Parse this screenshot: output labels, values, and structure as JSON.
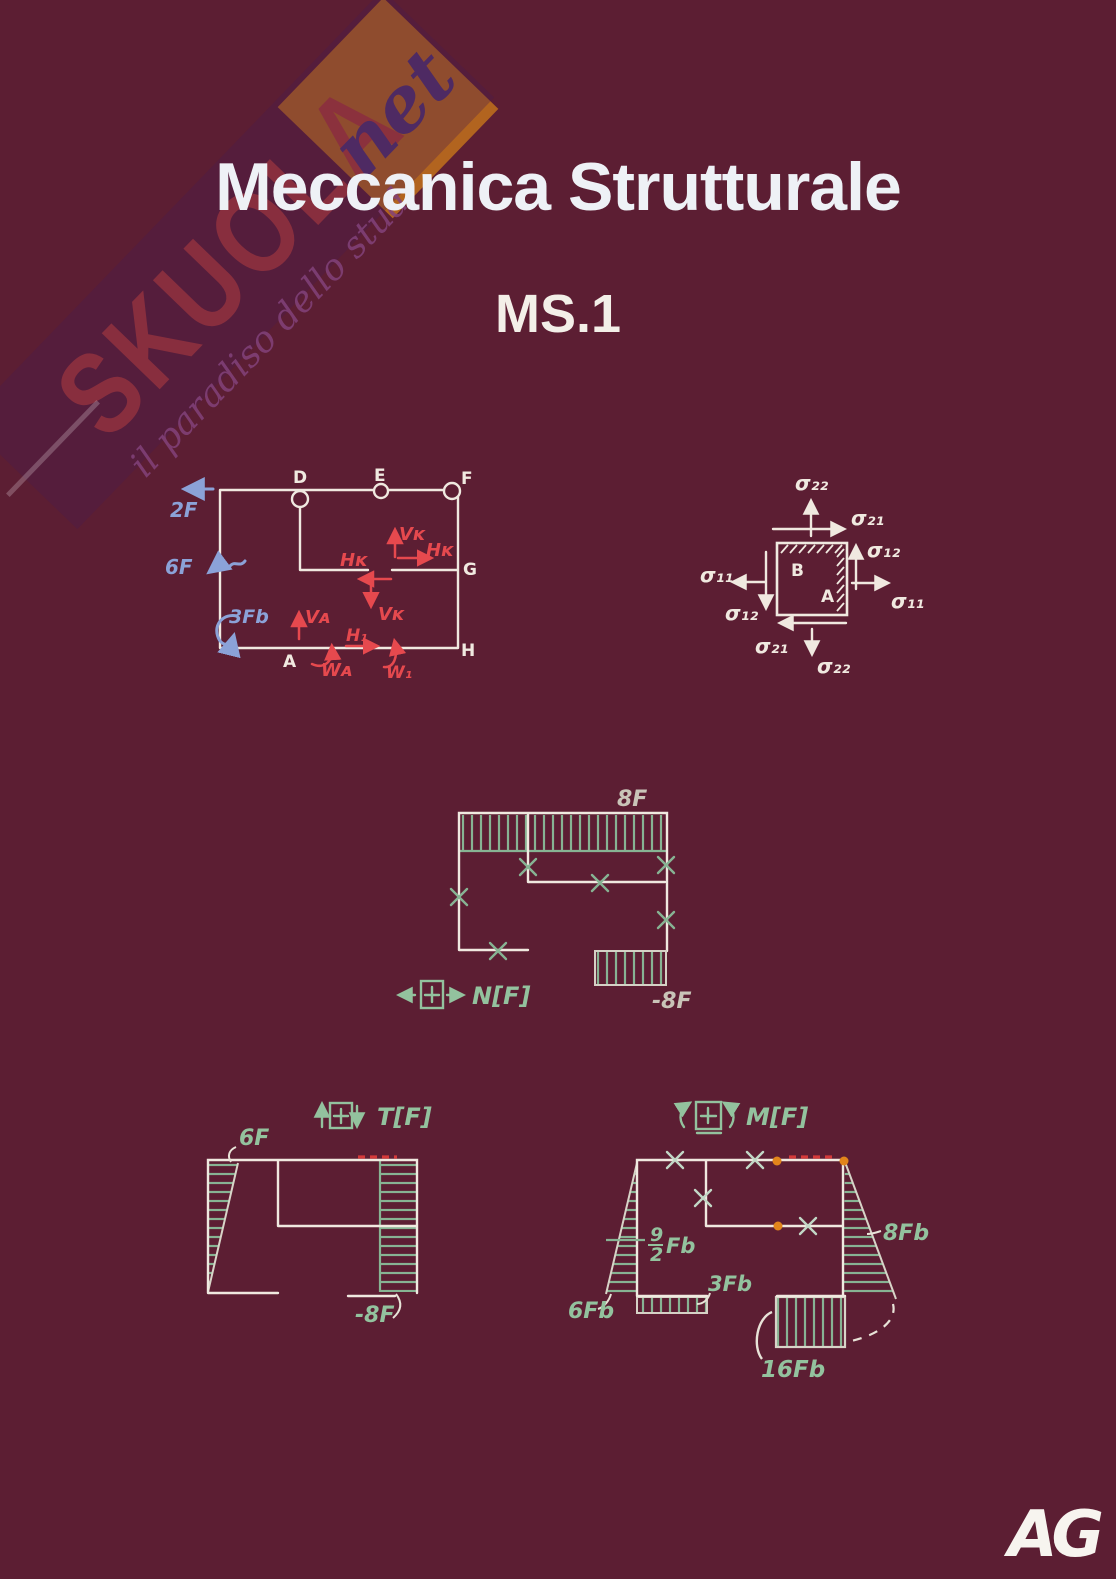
{
  "colors": {
    "background": "#5c1e33",
    "ink_white": "#f0e9e0",
    "annotation_red": "#e6494e",
    "annotation_blue": "#8ba2d8",
    "diagram_green": "#87b393",
    "highlight_orange": "#e2851b",
    "dash_red": "#d43a3a",
    "watermark_band": "#4e1c4e",
    "watermark_brand_red": "#8b2f3e",
    "watermark_orange": "#b2641f",
    "watermark_net_purple": "#4e2a63"
  },
  "watermark": {
    "brand": "SKUOLA",
    "suffix": "net",
    "tagline": "il paradiso dello stud"
  },
  "header": {
    "title": "Meccanica Strutturale",
    "subtitle": "MS.1"
  },
  "frame_diagram": {
    "nodes": {
      "d": "D",
      "e": "E",
      "f": "F",
      "g": "G",
      "h": "H",
      "a": "A"
    },
    "loads": {
      "f2": "2F",
      "f6": "6F",
      "m3fb": "3Fb"
    },
    "internal_forces": {
      "vk": "Vᴋ",
      "hk": "Hᴋ",
      "va": "Vᴀ",
      "wa": "Wᴀ",
      "h1": "H₁",
      "w1": "W₁"
    }
  },
  "stress_element": {
    "s22": "σ₂₂",
    "s21": "σ₂₁",
    "s12": "σ₁₂",
    "s11": "σ₁₁",
    "region_b": "B",
    "region_a": "A"
  },
  "n_diagram": {
    "legend": "N[F]",
    "top_value": "8F",
    "bottom_value": "-8F"
  },
  "t_diagram": {
    "legend": "T[F]",
    "left_value": "6F",
    "right_value": "-8F"
  },
  "m_diagram": {
    "legend": "M[F]",
    "frac_num": "9",
    "frac_den": "2",
    "frac_unit": "Fb",
    "left_value": "6Fb",
    "bottom_left_value": "3Fb",
    "right_value": "8Fb",
    "bottom_right_value": "16Fb"
  },
  "footer": {
    "logo": "AG"
  }
}
